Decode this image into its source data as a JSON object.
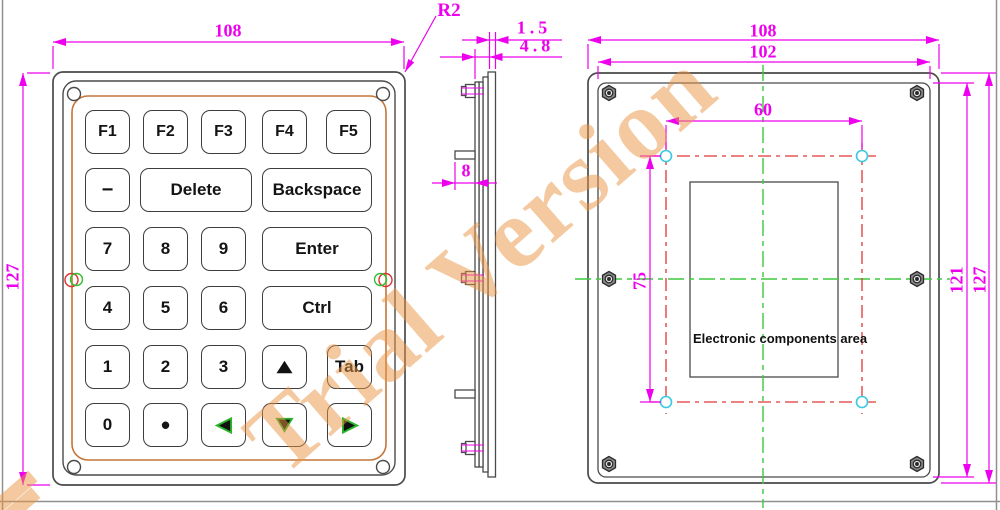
{
  "watermark": {
    "text": "Trial Version"
  },
  "front_view": {
    "width_dim": "108",
    "height_dim": "127",
    "corner_radius_label": "R2",
    "keys": [
      {
        "label": "F1"
      },
      {
        "label": "F2"
      },
      {
        "label": "F3"
      },
      {
        "label": "F4"
      },
      {
        "label": "F5"
      },
      {
        "label": "−"
      },
      {
        "label": "Delete"
      },
      {
        "label": "Backspace"
      },
      {
        "label": "7"
      },
      {
        "label": "8"
      },
      {
        "label": "9"
      },
      {
        "label": "Enter"
      },
      {
        "label": "4"
      },
      {
        "label": "5"
      },
      {
        "label": "6"
      },
      {
        "label": "Ctrl"
      },
      {
        "label": "1"
      },
      {
        "label": "2"
      },
      {
        "label": "3"
      },
      {
        "icon": "arrow-up-icon"
      },
      {
        "label": "Tab"
      },
      {
        "label": "0"
      },
      {
        "label": "•"
      },
      {
        "icon": "arrow-left-icon"
      },
      {
        "icon": "arrow-down-icon"
      },
      {
        "icon": "arrow-right-icon"
      }
    ]
  },
  "side_view": {
    "back_panel_thickness_dim": "1.5",
    "total_thickness_dim": "4.8",
    "stud_length_dim": "8"
  },
  "back_view": {
    "width_dim": "108",
    "inner_width_dim": "102",
    "hole_span_width_dim": "60",
    "hole_span_height_dim": "75",
    "inner_height_dim": "121",
    "height_dim": "127",
    "components_area_label": "Electronic components area"
  },
  "colors": {
    "dimension": "#ee00ee",
    "centerline_green": "#3ec83e",
    "hole_axis_red": "#e03636",
    "hole_marker_cyan": "#3cc8e0",
    "bezel_outline_orange": "#c4763a",
    "watermark_orange": "#e99442",
    "line_gray": "#4a4a4a"
  }
}
